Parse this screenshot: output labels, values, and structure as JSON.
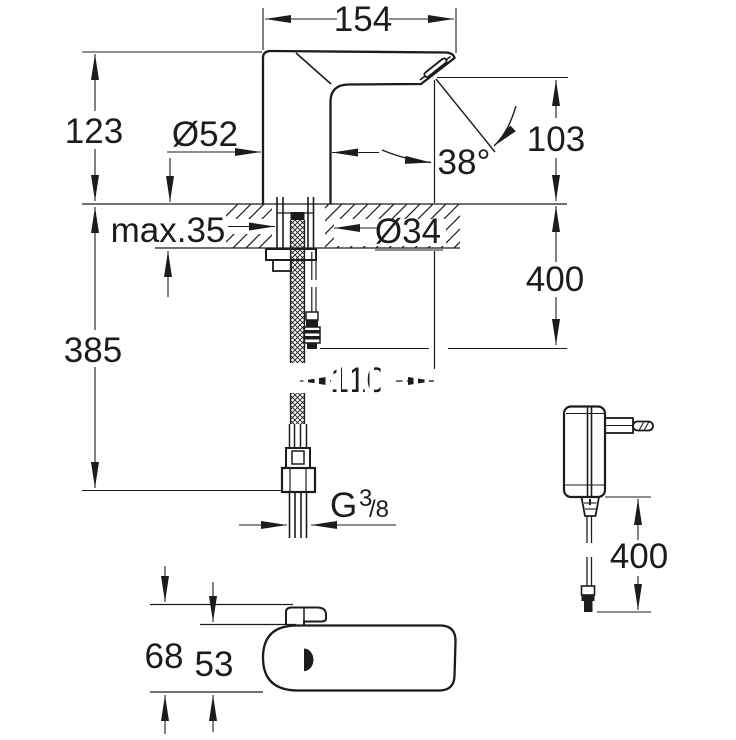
{
  "colors": {
    "ink": "#1c1c1c",
    "paper": "#ffffff"
  },
  "side_view": {
    "spout_width": "154",
    "height_above_deck": "123",
    "base_diameter": "Ø52",
    "spray_angle": "38°",
    "outlet_height": "103",
    "max_deck_thickness": "max.35",
    "mounting_hole_diameter": "Ø34",
    "cable_length": "400",
    "height_below_deck": "385",
    "spout_projection": "110",
    "thread_letter": "G",
    "thread_numerator": "3",
    "thread_denominator": "/8"
  },
  "top_view": {
    "overall_depth": "68",
    "body_depth": "53"
  },
  "power_supply": {
    "cable_length": "400"
  }
}
